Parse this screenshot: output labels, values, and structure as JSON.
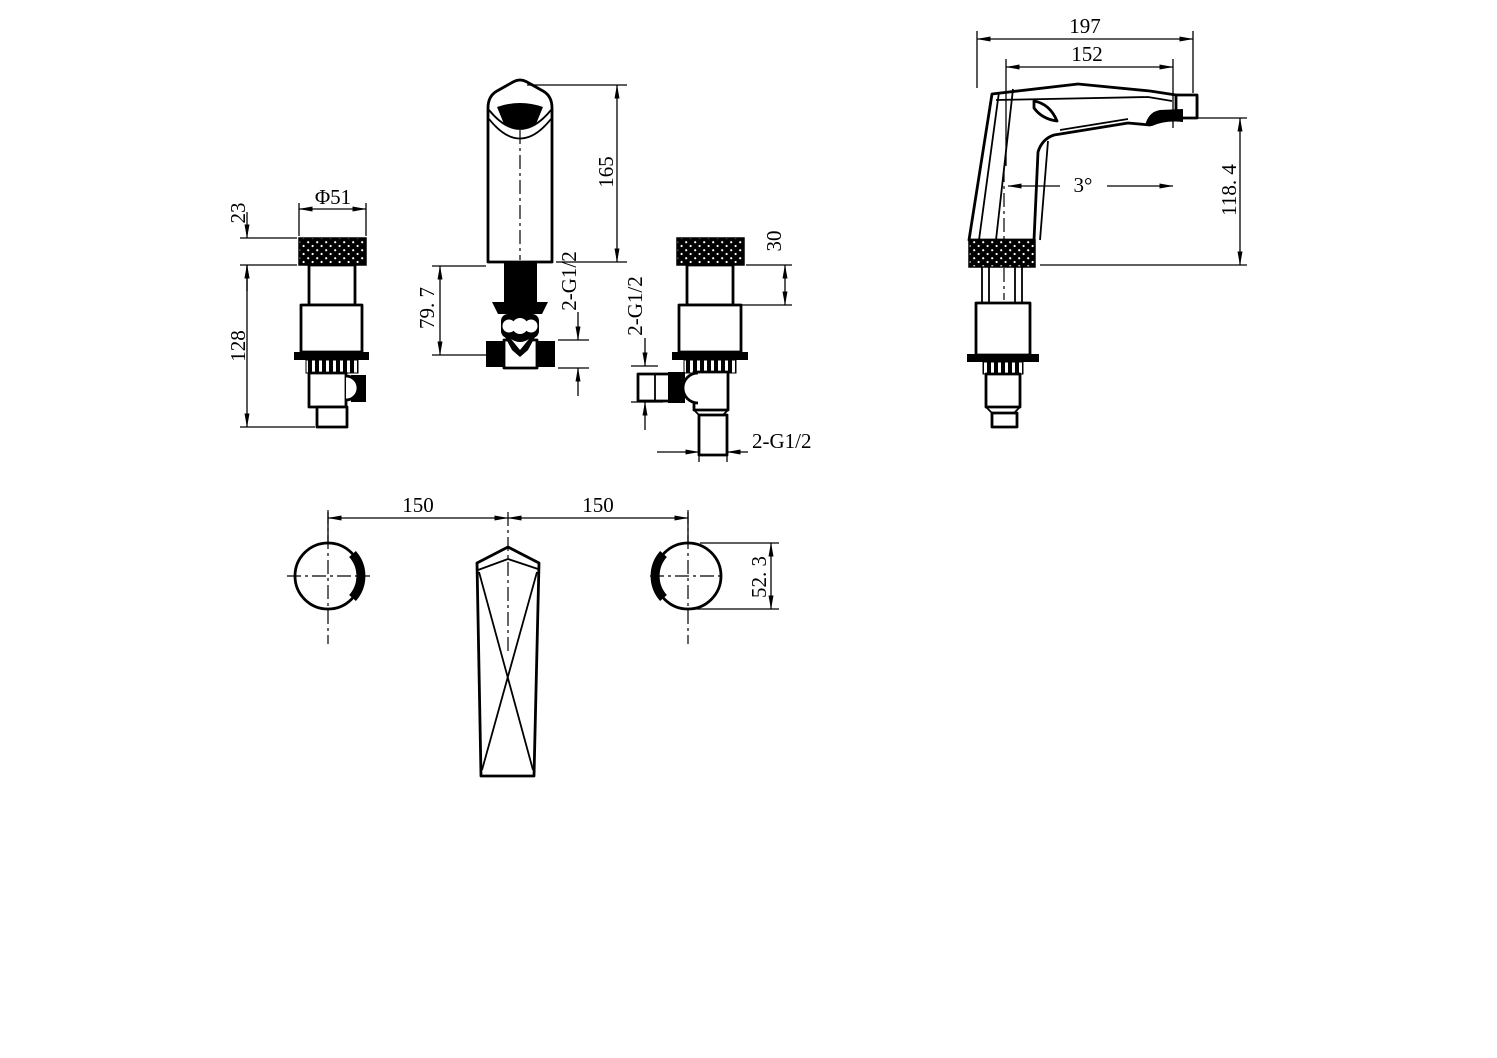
{
  "drawing": {
    "background_color": "#ffffff",
    "line_color": "#000000",
    "description": "Three-hole basin mixer faucet dimension drawing with five orthographic views",
    "views": {
      "handle_front": {
        "dims": {
          "diameter": "Φ51",
          "cap_height": "23",
          "below_deck_height": "128"
        }
      },
      "spout_front": {
        "dims": {
          "height_above_deck": "165",
          "below_deck_depth": "79. 7",
          "connector_thread": "2-G1/2"
        }
      },
      "valve_side": {
        "dims": {
          "neck_height": "30",
          "side_port_thread": "2-G1/2",
          "inlet_thread": "2-G1/2"
        }
      },
      "spout_side": {
        "dims": {
          "overall_length": "197",
          "reach": "152",
          "outlet_angle": "3°",
          "outlet_height": "118. 4"
        }
      },
      "plan": {
        "dims": {
          "handle_pitch_left": "150",
          "handle_pitch_right": "150",
          "handle_width": "52. 3"
        }
      }
    }
  }
}
